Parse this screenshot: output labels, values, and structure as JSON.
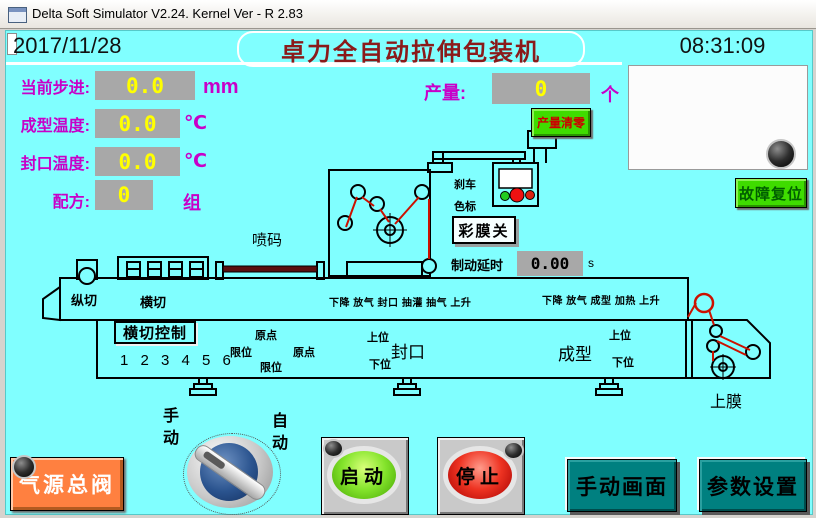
{
  "window": {
    "title": "Delta Soft Simulator V2.24. Kernel Ver - R 2.83"
  },
  "header": {
    "date": "2017/11/28",
    "machine_title": "卓力全自动拉伸包装机",
    "time": "08:31:09"
  },
  "readouts": [
    {
      "label": "当前步进:",
      "value": "0.0",
      "unit": "mm"
    },
    {
      "label": "成型温度:",
      "value": "0.0",
      "unit": "℃"
    },
    {
      "label": "封口温度:",
      "value": "0.0",
      "unit": "℃"
    },
    {
      "label": "配方:",
      "value": "0",
      "unit": "组"
    }
  ],
  "production": {
    "label": "产量:",
    "value": "0",
    "unit": "个",
    "clear_button": "产量清零"
  },
  "buttons": {
    "fault_reset": "故障复位",
    "film_toggle": "彩膜关",
    "crosscut_control": "横切控制",
    "air_valve": "气源总阀",
    "start": "启动",
    "stop": "停止",
    "manual_screen": "手动画面",
    "param_settings": "参数设置"
  },
  "diagram": {
    "printer": "喷码",
    "brake_line1": "刹车",
    "brake_line2": "色标",
    "brake_delay": {
      "label": "制动延时",
      "value": "0.00",
      "unit": "s"
    },
    "slitter": "纵切",
    "crosscut": "横切",
    "seal_sequence": "下降 放气 封口 抽灌 抽气 上升",
    "form_sequence": "下降 放气 成型 加热 上升",
    "station_digits": "1 2 3 4 5 6",
    "origin_a": "原点",
    "limit_a": "限位",
    "origin_b": "原点",
    "limit_b": "限位",
    "seal_upper": "上位",
    "seal_lower": "下位",
    "seal_station": "封口",
    "form_upper": "上位",
    "form_lower": "下位",
    "form_station": "成型",
    "upper_film": "上膜"
  },
  "selector": {
    "manual": "手动",
    "auto": "自动"
  },
  "colors": {
    "screen_bg": "#80FFFF",
    "label_magenta": "#C800C8",
    "value_yellow": "#FFFF00",
    "value_box_gray": "#A8A8A8",
    "button_green": "#3FDC00",
    "button_orange": "#FF8040",
    "button_teal": "#008080",
    "title_maroon": "#8B1A1A",
    "film_red": "#CC1100"
  }
}
